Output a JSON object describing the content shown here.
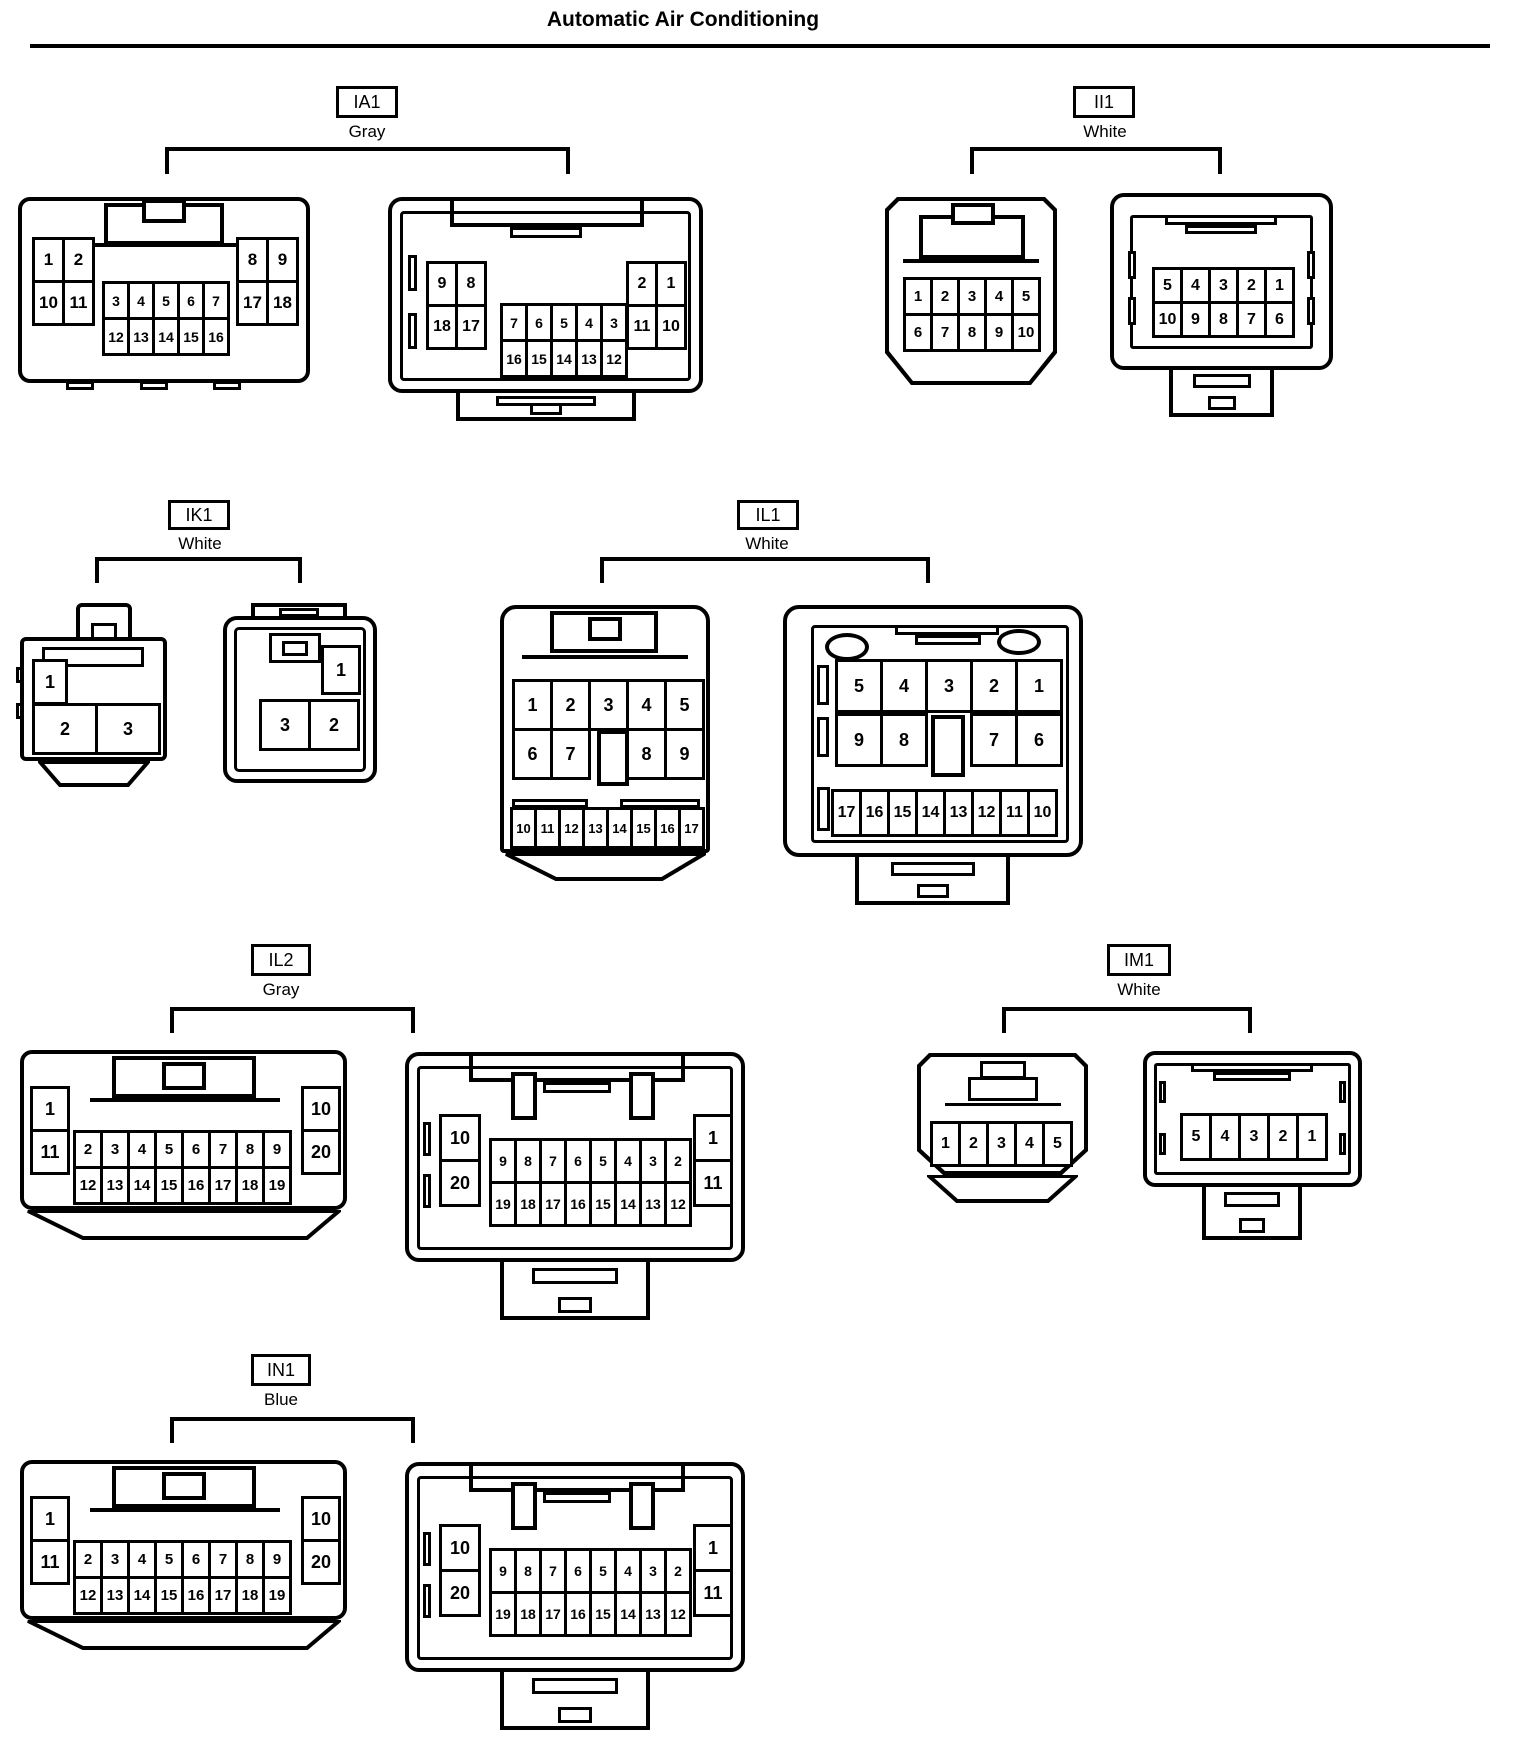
{
  "title": "Automatic Air Conditioning",
  "groups": [
    {
      "id": "IA1",
      "color": "Gray"
    },
    {
      "id": "II1",
      "color": "White"
    },
    {
      "id": "IK1",
      "color": "White"
    },
    {
      "id": "IL1",
      "color": "White"
    },
    {
      "id": "IL2",
      "color": "Gray"
    },
    {
      "id": "IM1",
      "color": "White"
    },
    {
      "id": "IN1",
      "color": "Blue"
    }
  ],
  "pins": {
    "ia1L_a": [
      "1",
      "2",
      "10",
      "11"
    ],
    "ia1L_c": [
      "3",
      "4",
      "5",
      "6",
      "7",
      "12",
      "13",
      "14",
      "15",
      "16"
    ],
    "ia1L_b": [
      "8",
      "9",
      "17",
      "18"
    ],
    "ia1R_a": [
      "9",
      "8",
      "18",
      "17"
    ],
    "ia1R_c": [
      "7",
      "6",
      "5",
      "4",
      "3",
      "16",
      "15",
      "14",
      "13",
      "12"
    ],
    "ia1R_b": [
      "2",
      "1",
      "11",
      "10"
    ],
    "ii1L": [
      "1",
      "2",
      "3",
      "4",
      "5",
      "6",
      "7",
      "8",
      "9",
      "10"
    ],
    "ii1R": [
      "5",
      "4",
      "3",
      "2",
      "1",
      "10",
      "9",
      "8",
      "7",
      "6"
    ],
    "ik1L_1": [
      "1"
    ],
    "ik1L_23": [
      "2",
      "3"
    ],
    "ik1R_1": [
      "1"
    ],
    "ik1R_32": [
      "3",
      "2"
    ],
    "il1L_r1": [
      "1",
      "2",
      "3",
      "4",
      "5"
    ],
    "il1L_r2a": [
      "6",
      "7"
    ],
    "il1L_r2b": [
      "8",
      "9"
    ],
    "il1L_r3": [
      "10",
      "11",
      "12",
      "13",
      "14",
      "15",
      "16",
      "17"
    ],
    "il1R_r1": [
      "5",
      "4",
      "3",
      "2",
      "1"
    ],
    "il1R_r2a": [
      "9",
      "8"
    ],
    "il1R_r2b": [
      "7",
      "6"
    ],
    "il1R_r3": [
      "17",
      "16",
      "15",
      "14",
      "13",
      "12",
      "11",
      "10"
    ],
    "il2L_side1": [
      "1",
      "11"
    ],
    "il2L_center": [
      "2",
      "3",
      "4",
      "5",
      "6",
      "7",
      "8",
      "9",
      "12",
      "13",
      "14",
      "15",
      "16",
      "17",
      "18",
      "19"
    ],
    "il2L_side2": [
      "10",
      "20"
    ],
    "il2R_side1": [
      "10",
      "20"
    ],
    "il2R_center": [
      "9",
      "8",
      "7",
      "6",
      "5",
      "4",
      "3",
      "2",
      "19",
      "18",
      "17",
      "16",
      "15",
      "14",
      "13",
      "12"
    ],
    "il2R_side2": [
      "1",
      "11"
    ],
    "im1L": [
      "1",
      "2",
      "3",
      "4",
      "5"
    ],
    "im1R": [
      "5",
      "4",
      "3",
      "2",
      "1"
    ],
    "in1L_side1": [
      "1",
      "11"
    ],
    "in1L_center": [
      "2",
      "3",
      "4",
      "5",
      "6",
      "7",
      "8",
      "9",
      "12",
      "13",
      "14",
      "15",
      "16",
      "17",
      "18",
      "19"
    ],
    "in1L_side2": [
      "10",
      "20"
    ],
    "in1R_side1": [
      "10",
      "20"
    ],
    "in1R_center": [
      "9",
      "8",
      "7",
      "6",
      "5",
      "4",
      "3",
      "2",
      "19",
      "18",
      "17",
      "16",
      "15",
      "14",
      "13",
      "12"
    ],
    "in1R_side2": [
      "1",
      "11"
    ]
  }
}
